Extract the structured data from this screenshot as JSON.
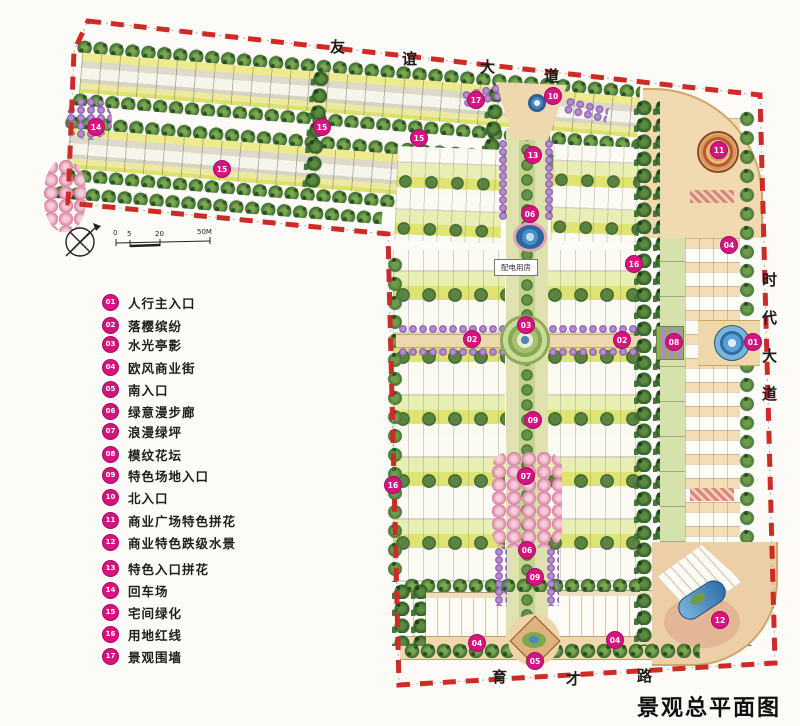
{
  "title": "景观总平面图",
  "roads": {
    "top": {
      "name": "友谊大道",
      "chars": [
        "友",
        "谊",
        "大",
        "道"
      ]
    },
    "right": {
      "name": "时代大道",
      "chars": [
        "时",
        "代",
        "大",
        "道"
      ]
    },
    "bottom": {
      "name": "育才路",
      "chars": [
        "育",
        "才",
        "路"
      ]
    }
  },
  "scale_bar": {
    "labels": [
      "0",
      "5",
      "20",
      "50M"
    ]
  },
  "plan_labels": {
    "power_room": "配电用房"
  },
  "legend": {
    "items": [
      {
        "num": "01",
        "label": "人行主入口"
      },
      {
        "num": "02",
        "label": "落樱缤纷"
      },
      {
        "num": "03",
        "label": "水光亭影"
      },
      {
        "num": "04",
        "label": "欧风商业街"
      },
      {
        "num": "05",
        "label": "南入口"
      },
      {
        "num": "06",
        "label": "绿意漫步廊"
      },
      {
        "num": "07",
        "label": "浪漫绿坪"
      },
      {
        "num": "08",
        "label": "模纹花坛"
      },
      {
        "num": "09",
        "label": "特色场地入口"
      },
      {
        "num": "10",
        "label": "北入口"
      },
      {
        "num": "11",
        "label": "商业广场特色拼花"
      },
      {
        "num": "12",
        "label": "商业特色跌级水景"
      },
      {
        "num": "13",
        "label": "特色入口拼花"
      },
      {
        "num": "14",
        "label": "回车场"
      },
      {
        "num": "15",
        "label": "宅间绿化"
      },
      {
        "num": "16",
        "label": "用地红线"
      },
      {
        "num": "17",
        "label": "景观围墙"
      }
    ]
  },
  "plan_markers": [
    {
      "num": "14",
      "x": 95,
      "y": 126
    },
    {
      "num": "15",
      "x": 221,
      "y": 168
    },
    {
      "num": "15",
      "x": 321,
      "y": 126
    },
    {
      "num": "15",
      "x": 418,
      "y": 137
    },
    {
      "num": "17",
      "x": 475,
      "y": 99
    },
    {
      "num": "10",
      "x": 552,
      "y": 95
    },
    {
      "num": "13",
      "x": 532,
      "y": 154
    },
    {
      "num": "06",
      "x": 529,
      "y": 213
    },
    {
      "num": "16",
      "x": 633,
      "y": 263
    },
    {
      "num": "11",
      "x": 718,
      "y": 149
    },
    {
      "num": "04",
      "x": 728,
      "y": 244
    },
    {
      "num": "03",
      "x": 525,
      "y": 324
    },
    {
      "num": "02",
      "x": 471,
      "y": 338
    },
    {
      "num": "02",
      "x": 621,
      "y": 339
    },
    {
      "num": "08",
      "x": 673,
      "y": 341
    },
    {
      "num": "01",
      "x": 752,
      "y": 341
    },
    {
      "num": "09",
      "x": 532,
      "y": 419
    },
    {
      "num": "16",
      "x": 392,
      "y": 484
    },
    {
      "num": "07",
      "x": 525,
      "y": 475
    },
    {
      "num": "06",
      "x": 526,
      "y": 549
    },
    {
      "num": "09",
      "x": 534,
      "y": 576
    },
    {
      "num": "04",
      "x": 476,
      "y": 642
    },
    {
      "num": "04",
      "x": 614,
      "y": 639
    },
    {
      "num": "05",
      "x": 534,
      "y": 660
    },
    {
      "num": "12",
      "x": 719,
      "y": 619
    }
  ],
  "colors": {
    "boundary_red": "#cd2b26",
    "marker_magenta": "#d61380",
    "tree_green": "#47763a",
    "lawn_green": "#dde472",
    "paving_tan": "#eed9ae",
    "water_blue": "#3f7fb8",
    "blossom_purple": "#8653ad"
  }
}
